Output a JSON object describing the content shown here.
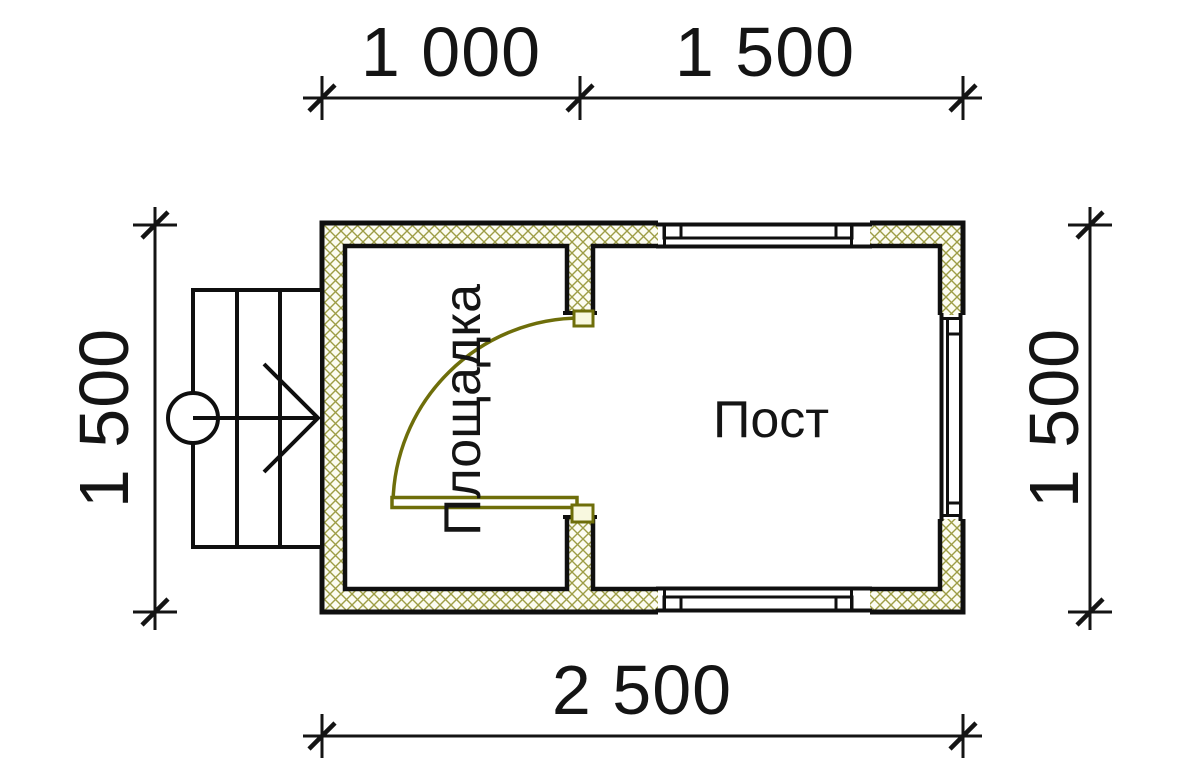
{
  "title": "Floor plan 2500x1500 with porch",
  "rooms": {
    "left": {
      "label": "Площадка"
    },
    "right": {
      "label": "Пост"
    }
  },
  "dimensions": {
    "top_left": "1 000",
    "top_right": "1 500",
    "left": "1 500",
    "right": "1 500",
    "bottom": "2 500"
  },
  "watermark": {
    "text": "VANDA",
    "pink_block": "#f6cdd2",
    "light_blue_block": "#d9e8f6",
    "mid_blue_block": "#c5d6e8",
    "text_color": "#ffffff"
  },
  "colors": {
    "outline": "#0f0f0f",
    "wall_hatch": "#9d9d45",
    "wall_fill": "#fcfcf1",
    "door_olive": "#6e6e0a"
  }
}
